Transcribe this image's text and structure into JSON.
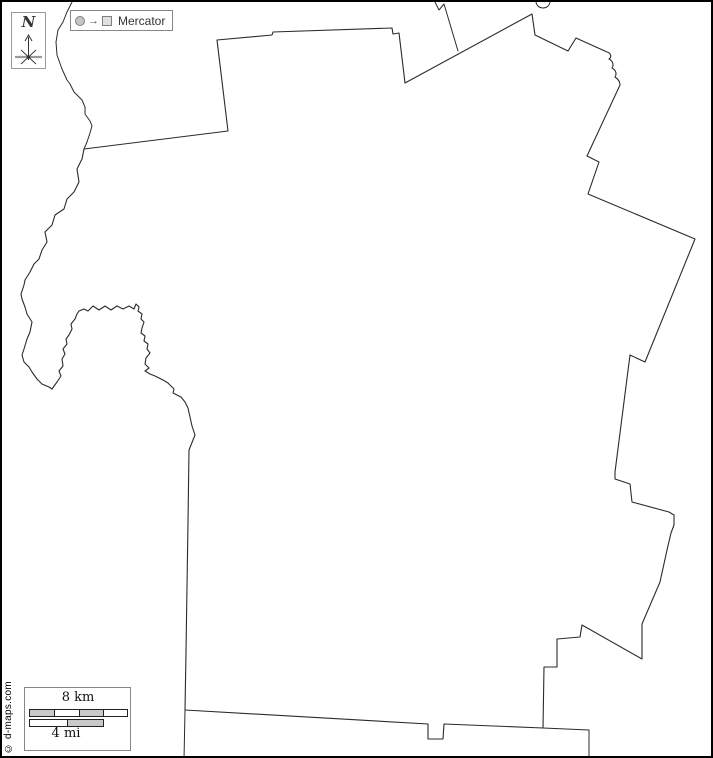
{
  "compass": {
    "label": "N"
  },
  "projection_badge": {
    "arrow": "→",
    "label": "Mercator"
  },
  "scale_bar": {
    "km_label": "8 km",
    "mi_label": "4 mi"
  },
  "credit": "© d-maps.com",
  "colors": {
    "background": "#ffffff",
    "line": "#2b2b2b",
    "frame": "#000000",
    "widget_border": "#888888",
    "bar_gray": "#c9c9c9"
  },
  "map": {
    "paths": {
      "county": "M 215,38 L 270,33 L 271,30 L 390,26 L 391,32 L 397,31 L 403,81 L 530,12 L 533,33 L 566,49 L 574,36 L 605,50 C 609,51 610,55 607,57 C 611,59 612,63 610,66 C 614,68 615,72 613,75 C 616,77 618,80 618,83 L 585,154 L 597,160 L 586,192 L 693,237 L 643,360 L 628,353 L 613,470 L 613,477 L 628,482 L 630,500 L 667,510 L 672,513 L 672,523 L 669,531 L 665,548 L 658,580 L 640,622 L 640,657 L 580,623 L 578,635 L 555,637 L 555,665 L 542,665 L 541,726 L 442,722 L 441,737 L 426,737 L 426,722 L 183,708 L 184,650 L 186,520 L 187,448 L 191,438 L 193,433 L 190,424 L 188,415 L 186,406 L 183,400 L 179,395 L 171,391 L 172,387 L 166,381 L 161,378 L 153,374 L 148,372 L 143,369 L 147,366 L 143,362 L 144,356 L 148,351 L 145,347 L 146,342 L 142,339 L 143,334 L 139,331 L 140,326 L 142,320 L 139,317 L 140,312 L 136,309 L 137,305 L 134,302 L 132,307 L 127,304 L 121,307 L 115,304 L 109,308 L 103,304 L 97,308 L 91,304 L 86,309 L 82,307 L 77,309 L 75,312 L 73,317 L 69,322 L 70,327 L 67,333 L 64,337 L 65,342 L 61,347 L 63,352 L 60,357 L 61,364 L 57,369 L 59,374 L 55,380 L 50,387 L 47,385 L 40,382 L 35,377 L 30,370 L 27,365 L 22,360 L 20,353 L 22,347 L 25,337 L 28,330 L 30,320 L 25,312 L 23,305 L 20,297 L 19,292 L 22,283 L 23,278 L 28,270 L 32,262 L 37,257 L 40,248 L 45,240 L 43,230 L 50,223 L 53,213 L 62,207 L 65,197 L 72,190 L 77,180 L 75,167 L 80,157 L 82,147 L 226,129 Z",
      "river_north": "M 70,0 L 65,10 L 61,20 L 56,28 L 54,40 L 55,53 L 60,67 L 65,78 L 68,82 L 72,90 L 80,98 L 83,105 L 83,112 L 88,119 L 90,124 L 88,131 L 85,140 L 82,147",
      "top_notch": "M 433,0 L 437,8 L 442,2 L 456,49",
      "top_arc": "M 534,0 C 535,8 547,8 548,0",
      "bottom_left": "M 183,708 L 182,758",
      "bottom_right": "M 541,726 L 587,728 L 587,758"
    }
  }
}
